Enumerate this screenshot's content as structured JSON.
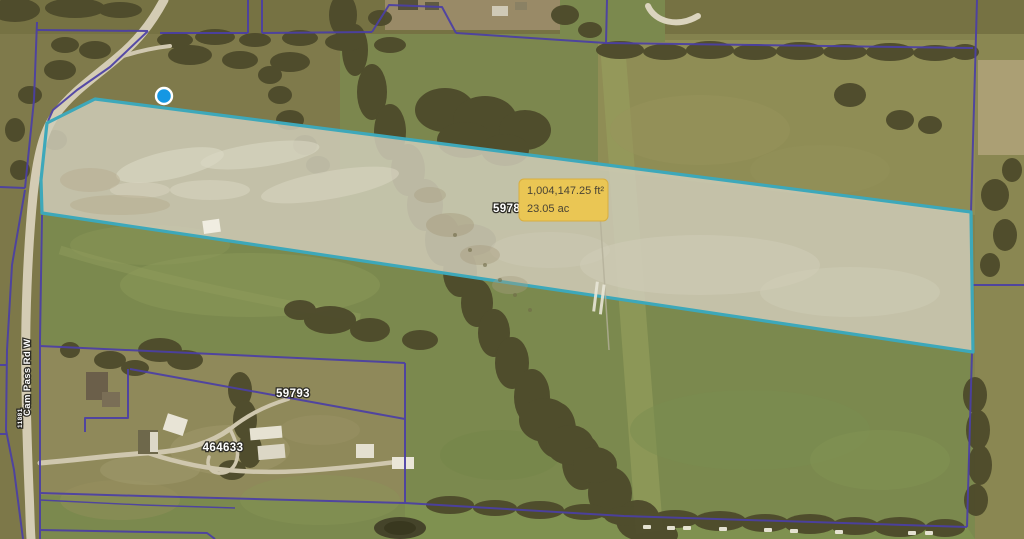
{
  "tooltip": {
    "area_sqft": "1,004,147.25 ft²",
    "area_acres": "23.05 ac"
  },
  "labels": {
    "parcel_partial": "5978",
    "parcel_59793": "59793",
    "parcel_464633": "464633",
    "road_name": "Cam Pass Rd W",
    "house_number": "11881"
  },
  "colors": {
    "selection_stroke": "#3da8ba",
    "parcel_line": "#4b3fa5",
    "tooltip_bg": "#eac654",
    "tooltip_border": "#d8ae3f",
    "marker_blue": "#1597e3"
  }
}
